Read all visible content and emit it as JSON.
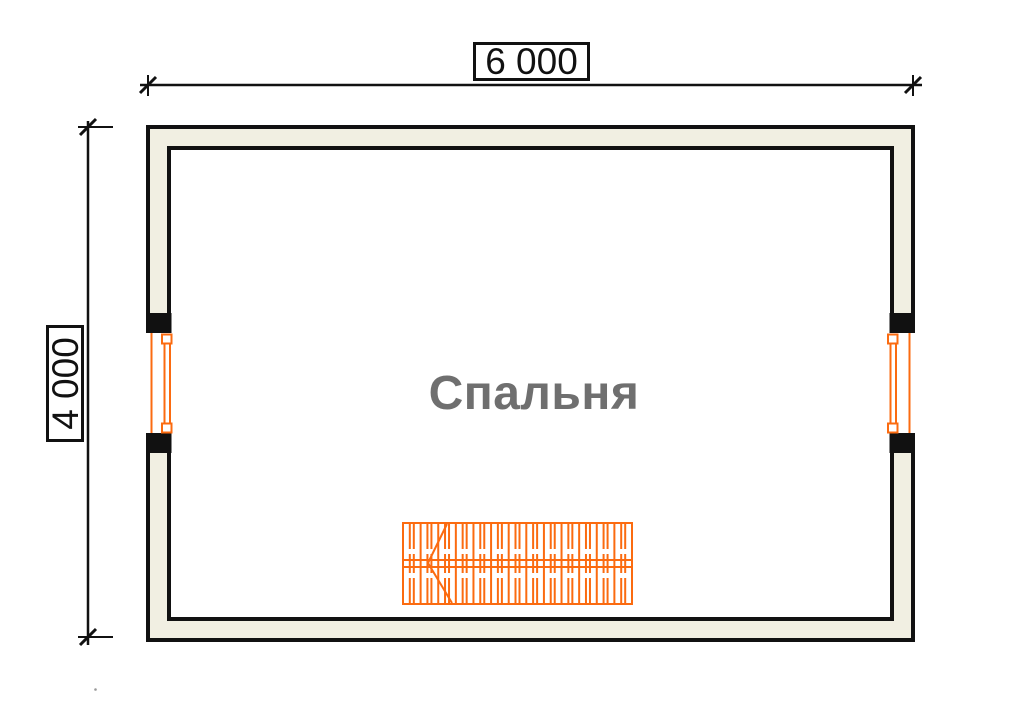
{
  "plan": {
    "room_label": "Спальня",
    "width_dimension": "6 000",
    "height_dimension": "4 000",
    "colors": {
      "background": "#ffffff",
      "wall_fill": "#f1efe2",
      "outline_black": "#111111",
      "joinery_orange": "#fb6b10",
      "room_label_gray": "#6f6f6f"
    },
    "symbols": [
      {
        "name": "window-symbol-left",
        "type": "window"
      },
      {
        "name": "window-symbol-right",
        "type": "window"
      },
      {
        "name": "staircase-symbol",
        "type": "stair"
      }
    ]
  }
}
